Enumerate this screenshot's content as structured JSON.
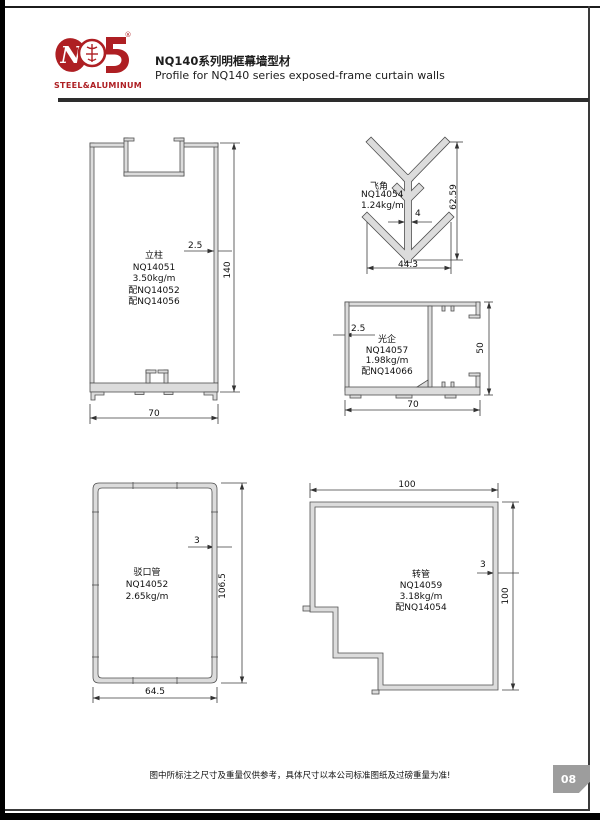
{
  "header": {
    "brand": "STEEL&ALUMINUM",
    "reg": "®",
    "title_zh": "NQ140系列明框幕墙型材",
    "title_en": "Profile for NQ140 series exposed-frame curtain walls"
  },
  "profiles": {
    "mullion": {
      "name": "立柱",
      "code": "NQ14051",
      "weight": "3.50kg/m",
      "pair1": "配NQ14052",
      "pair2": "配NQ14056",
      "dim_height": "140",
      "dim_width": "70",
      "dim_thickness": "2.5"
    },
    "fin": {
      "name": "飞角",
      "code": "NQ14054",
      "weight": "1.24kg/m",
      "dim_height": "62.59",
      "dim_width": "44.3",
      "dim_thickness": "4"
    },
    "stile": {
      "name": "光企",
      "code": "NQ14057",
      "weight": "1.98kg/m",
      "pair1": "配NQ14066",
      "dim_height": "50",
      "dim_width": "70",
      "dim_thickness": "2.5"
    },
    "splice_tube": {
      "name": "驳口管",
      "code": "NQ14052",
      "weight": "2.65kg/m",
      "dim_height": "106.5",
      "dim_width": "64.5",
      "dim_thickness": "3"
    },
    "corner_tube": {
      "name": "转管",
      "code": "NQ14059",
      "weight": "3.18kg/m",
      "pair1": "配NQ14054",
      "dim_height": "100",
      "dim_width": "100",
      "dim_thickness": "3"
    }
  },
  "footer": {
    "note": "图中所标注之尺寸及重量仅供参考，具体尺寸以本公司标准图纸及过磅重量为准!",
    "page_number": "08"
  },
  "colors": {
    "brand_red": "#ae1f23",
    "profile_fill": "#dcdcdc",
    "line_dark": "#333333",
    "tab_gray": "#9d9d9d"
  }
}
